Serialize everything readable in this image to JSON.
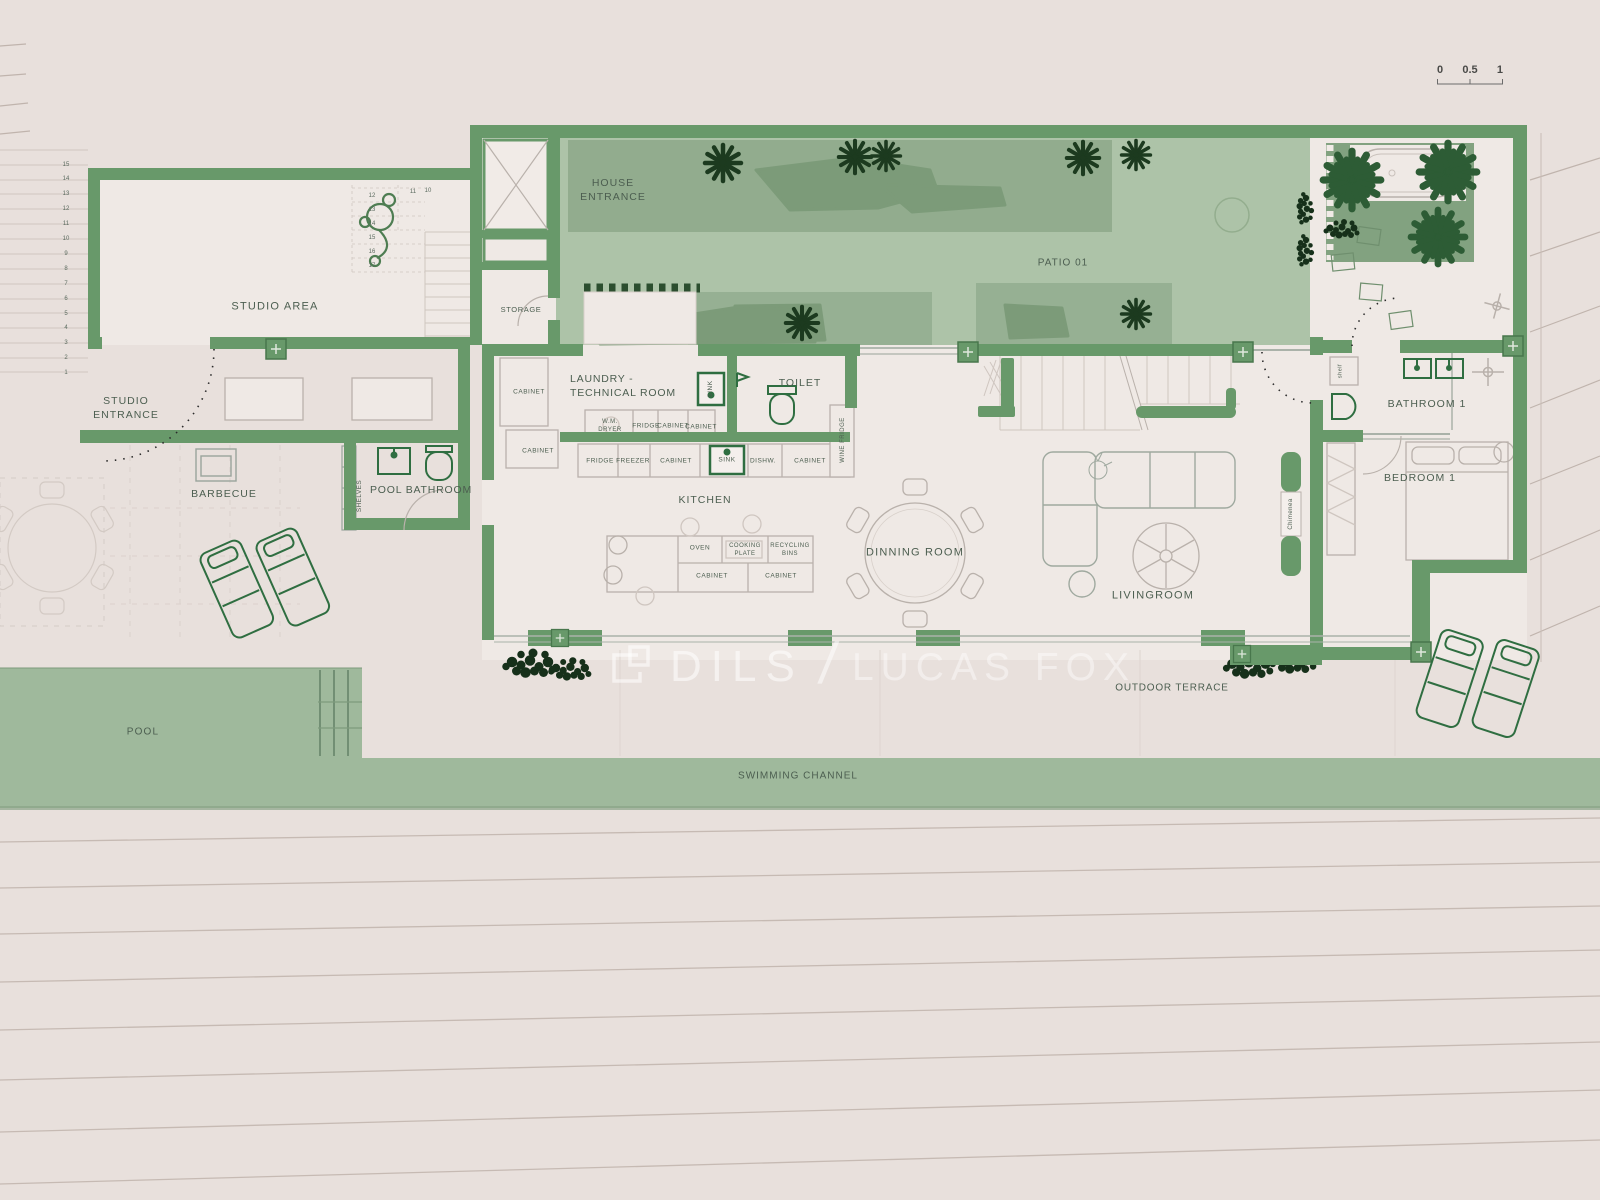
{
  "scalebar": {
    "ticks": [
      "0",
      "0.5",
      "1"
    ]
  },
  "watermark": {
    "brand_left": "DILS",
    "divider": "/",
    "brand_right": "LUCAS FOX"
  },
  "colors": {
    "background": "#e8e0dc",
    "wall_green": "#68996a",
    "patio_green": "#adc3a8",
    "shade_green": "#8faa8b",
    "garden_green": "#82a280",
    "pool_green": "#9fb99c",
    "foliage_dark": "#1c3a1f",
    "palm_green": "#2d5c35",
    "fixture_green": "#2f6e41",
    "label_text": "#4c5e50",
    "watermark_white": "rgba(255,255,255,0.55)"
  },
  "stairs": {
    "left_numbers": [
      "15",
      "14",
      "13",
      "12",
      "11",
      "10",
      "9",
      "8",
      "7",
      "6",
      "5",
      "4",
      "3",
      "2",
      "1"
    ],
    "studio_numbers_col": [
      "12",
      "13",
      "14",
      "15",
      "16",
      "17"
    ],
    "studio_numbers_row": [
      "11",
      "10"
    ]
  },
  "labels": [
    {
      "id": "studio-area",
      "text": "STUDIO AREA",
      "x": 275,
      "y": 307,
      "fs": 11,
      "ls": 1.2
    },
    {
      "id": "studio-entrance",
      "text": "STUDIO\nENTRANCE",
      "x": 126,
      "y": 408,
      "fs": 10.5,
      "ls": 1
    },
    {
      "id": "barbecue",
      "text": "BARBECUE",
      "x": 224,
      "y": 494,
      "fs": 10.5,
      "ls": 1
    },
    {
      "id": "shelves",
      "text": "SHELVES",
      "x": 360,
      "y": 496,
      "fs": 6.5,
      "v": true,
      "ls": 0.4
    },
    {
      "id": "pool-bathroom",
      "text": "POOL BATHROOM",
      "x": 421,
      "y": 490,
      "fs": 10.5,
      "ls": 0.8
    },
    {
      "id": "storage",
      "text": "STORAGE",
      "x": 521,
      "y": 310,
      "fs": 7.5,
      "ls": 0.6
    },
    {
      "id": "house-entrance",
      "text": "HOUSE\nENTRANCE",
      "x": 613,
      "y": 190,
      "fs": 10.5,
      "ls": 1
    },
    {
      "id": "patio-01",
      "text": "PATIO 01",
      "x": 1063,
      "y": 263,
      "fs": 10,
      "ls": 1
    },
    {
      "id": "laundry-technical-room",
      "text": "LAUNDRY -\nTECHNICAL ROOM",
      "x": 570,
      "y": 386,
      "fs": 10.5,
      "ls": 0.8,
      "align": "left"
    },
    {
      "id": "cabinet-1",
      "text": "CABINET",
      "x": 529,
      "y": 393,
      "fs": 6.5
    },
    {
      "id": "cabinet-2",
      "text": "CABINET",
      "x": 538,
      "y": 452,
      "fs": 6.5
    },
    {
      "id": "wm-dryer",
      "text": "W.M.\nDRYER",
      "x": 610,
      "y": 426,
      "fs": 6
    },
    {
      "id": "fridge-1",
      "text": "FRIDGE",
      "x": 646,
      "y": 427,
      "fs": 6.5
    },
    {
      "id": "cabinet-3",
      "text": "CABINET",
      "x": 673,
      "y": 427,
      "fs": 6.5
    },
    {
      "id": "cabinet-4",
      "text": "CABINET",
      "x": 701,
      "y": 428,
      "fs": 6.5
    },
    {
      "id": "sink-laundry",
      "text": "SINK",
      "x": 711,
      "y": 389,
      "fs": 6.5,
      "v": true
    },
    {
      "id": "toilet",
      "text": "TOILET",
      "x": 800,
      "y": 383,
      "fs": 10.5,
      "ls": 1
    },
    {
      "id": "fridge-2",
      "text": "FRIDGE",
      "x": 600,
      "y": 462,
      "fs": 6.5
    },
    {
      "id": "freezer",
      "text": "FREEZER",
      "x": 633,
      "y": 462,
      "fs": 6.5
    },
    {
      "id": "cabinet-5",
      "text": "CABINET",
      "x": 676,
      "y": 462,
      "fs": 6.5
    },
    {
      "id": "sink-kitchen",
      "text": "SINK",
      "x": 727,
      "y": 461,
      "fs": 6.5
    },
    {
      "id": "dishw",
      "text": "DISHW.",
      "x": 763,
      "y": 462,
      "fs": 6.5
    },
    {
      "id": "cabinet-6",
      "text": "CABINET",
      "x": 810,
      "y": 462,
      "fs": 6.5
    },
    {
      "id": "wine-fridge",
      "text": "WINE FRIDGE",
      "x": 843,
      "y": 440,
      "fs": 6,
      "v": true
    },
    {
      "id": "kitchen",
      "text": "KITCHEN",
      "x": 705,
      "y": 500,
      "fs": 10.5,
      "ls": 1
    },
    {
      "id": "oven",
      "text": "OVEN",
      "x": 700,
      "y": 549,
      "fs": 6.5
    },
    {
      "id": "cooking-plate",
      "text": "COOKING\nPLATE",
      "x": 745,
      "y": 550,
      "fs": 6
    },
    {
      "id": "recycling-bins",
      "text": "RECYCLING\nBINS",
      "x": 790,
      "y": 550,
      "fs": 6
    },
    {
      "id": "cabinet-7",
      "text": "CABINET",
      "x": 712,
      "y": 577,
      "fs": 6.5
    },
    {
      "id": "cabinet-8",
      "text": "CABINET",
      "x": 781,
      "y": 577,
      "fs": 6.5
    },
    {
      "id": "dinning-room",
      "text": "DINNING ROOM",
      "x": 915,
      "y": 553,
      "fs": 11,
      "ls": 1.2
    },
    {
      "id": "livingroom",
      "text": "LIVINGROOM",
      "x": 1153,
      "y": 596,
      "fs": 11,
      "ls": 1.2
    },
    {
      "id": "chimenea",
      "text": "Chimenea",
      "x": 1291,
      "y": 514,
      "fs": 6,
      "v": true
    },
    {
      "id": "shelf",
      "text": "shelf",
      "x": 1341,
      "y": 371,
      "fs": 5.5,
      "v": true
    },
    {
      "id": "bathroom-1",
      "text": "BATHROOM 1",
      "x": 1427,
      "y": 404,
      "fs": 10.5,
      "ls": 1
    },
    {
      "id": "bedroom-1",
      "text": "BEDROOM 1",
      "x": 1420,
      "y": 478,
      "fs": 10.5,
      "ls": 1
    },
    {
      "id": "outdoor-terrace",
      "text": "OUTDOOR TERRACE",
      "x": 1172,
      "y": 688,
      "fs": 10,
      "ls": 0.8
    },
    {
      "id": "pool",
      "text": "POOL",
      "x": 143,
      "y": 732,
      "fs": 10,
      "ls": 1.2
    },
    {
      "id": "swimming-channel",
      "text": "SWIMMING CHANNEL",
      "x": 798,
      "y": 776,
      "fs": 10,
      "ls": 1
    }
  ]
}
